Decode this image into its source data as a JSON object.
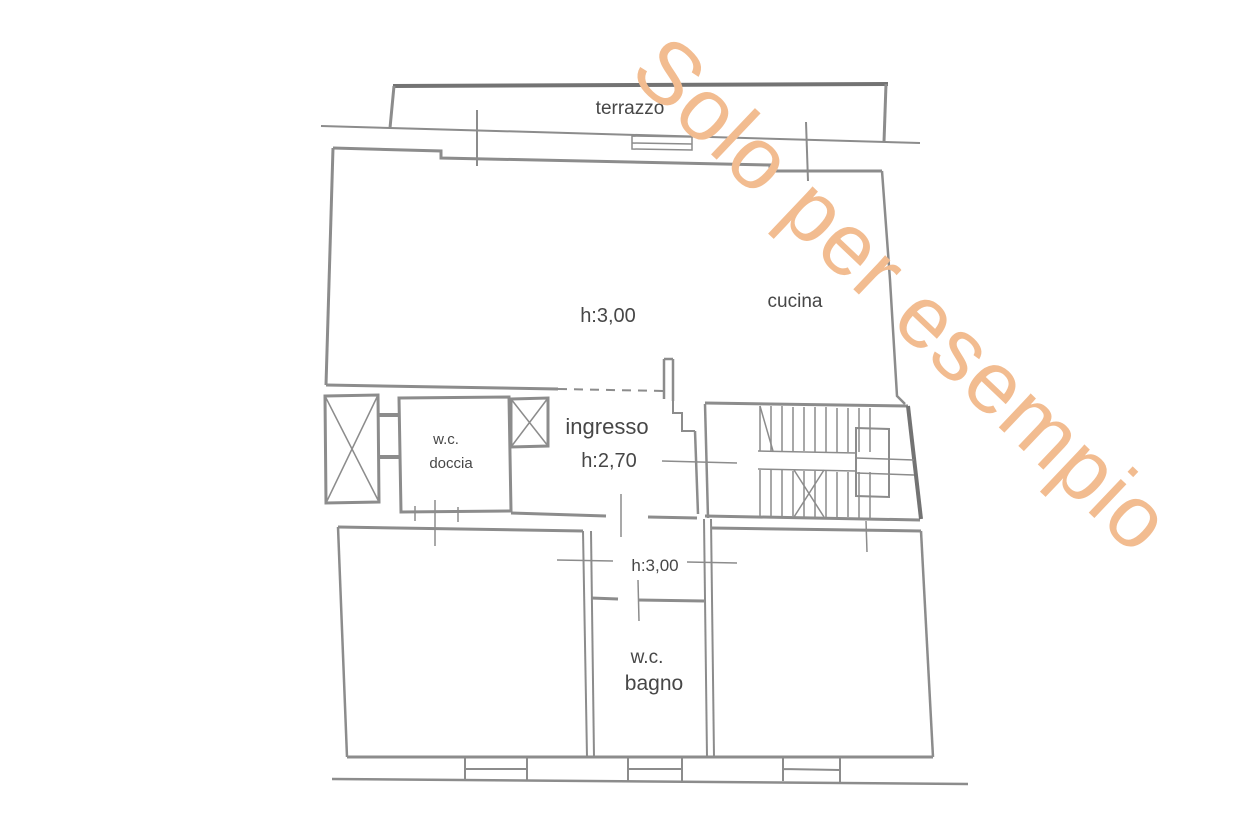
{
  "document": {
    "type_label": "apartment floor plan"
  },
  "watermark": {
    "text": "Solo per esempio",
    "rotation_deg": 43.5
  },
  "colors": {
    "wall_line": "#8c8c8c",
    "wall_dark": "#737373",
    "label_text": "#474747",
    "watermark": "#f2bc90",
    "background": "#ffffff"
  },
  "rooms": {
    "terrazzo": {
      "label": "terrazzo"
    },
    "soggiorno": {
      "height_label": "h:3,00"
    },
    "cucina": {
      "label": "cucina"
    },
    "ingresso": {
      "label": "ingresso",
      "height_label": "h:2,70"
    },
    "wc_doccia": {
      "label_line1": "w.c.",
      "label_line2": "doccia"
    },
    "disimpegno": {
      "height_label": "h:3,00"
    },
    "wc_bagno": {
      "label_line1": "w.c.",
      "label_line2": "bagno"
    }
  }
}
